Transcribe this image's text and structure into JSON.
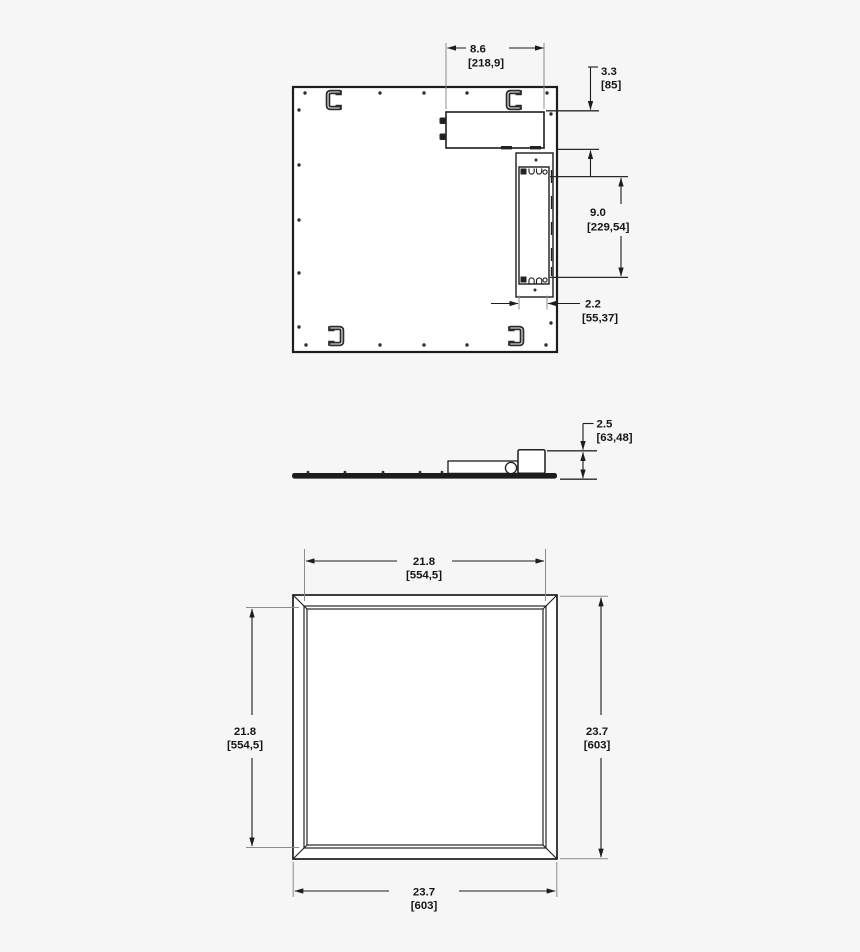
{
  "drawing": {
    "title": "led-panel-dimension-drawing",
    "background_color": "#f6f6f7",
    "line_color": "#1d1d1d",
    "views": {
      "back": {
        "dims": {
          "box_width": {
            "in": "8.6",
            "mm": "[218,9]"
          },
          "box_height": {
            "in": "3.3",
            "mm": "[85]"
          },
          "driver_length": {
            "in": "9.0",
            "mm": "[229,54]"
          },
          "driver_width": {
            "in": "2.2",
            "mm": "[55,37]"
          }
        }
      },
      "side": {
        "dims": {
          "depth": {
            "in": "2.5",
            "mm": "[63,48]"
          }
        }
      },
      "front": {
        "dims": {
          "opening_width": {
            "in": "21.8",
            "mm": "[554,5]"
          },
          "opening_height": {
            "in": "21.8",
            "mm": "[554,5]"
          },
          "overall_height": {
            "in": "23.7",
            "mm": "[603]"
          },
          "overall_width": {
            "in": "23.7",
            "mm": "[603]"
          }
        }
      }
    }
  }
}
